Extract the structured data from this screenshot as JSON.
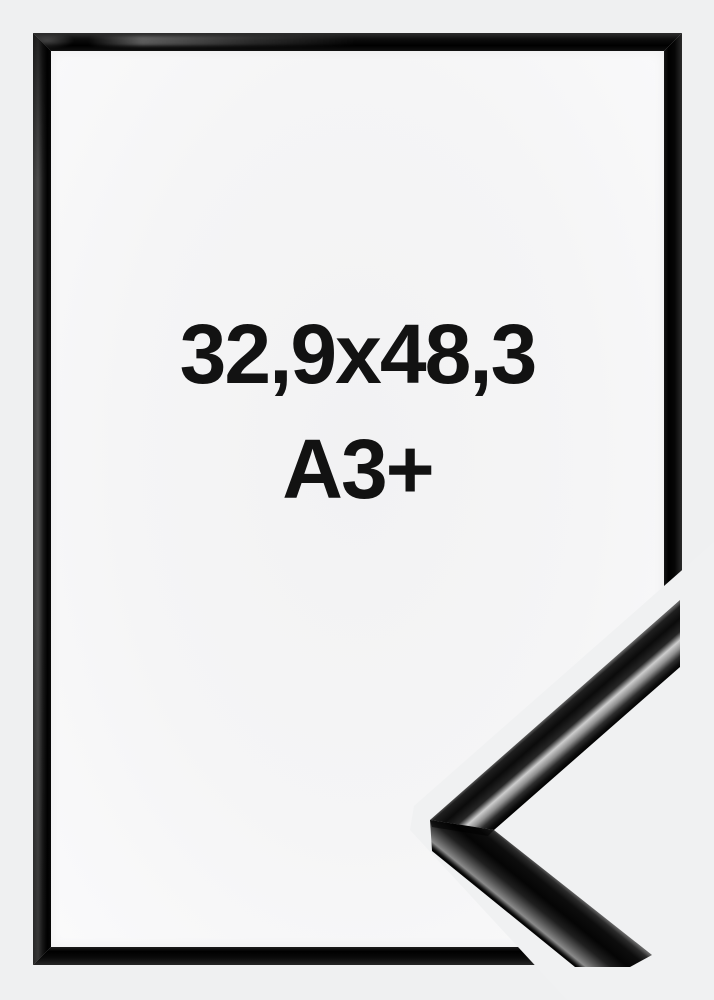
{
  "frame_label": {
    "line1": "32,9x48,3",
    "line2": "A3+"
  },
  "colors": {
    "background": "#eff0f1",
    "frame_black": "#0a0a0a",
    "frame_highlight_gray": "#4d4d4d",
    "profile_silver": "#c9c9c9",
    "interior": "#f5f5f6",
    "label_text": "#121212"
  }
}
